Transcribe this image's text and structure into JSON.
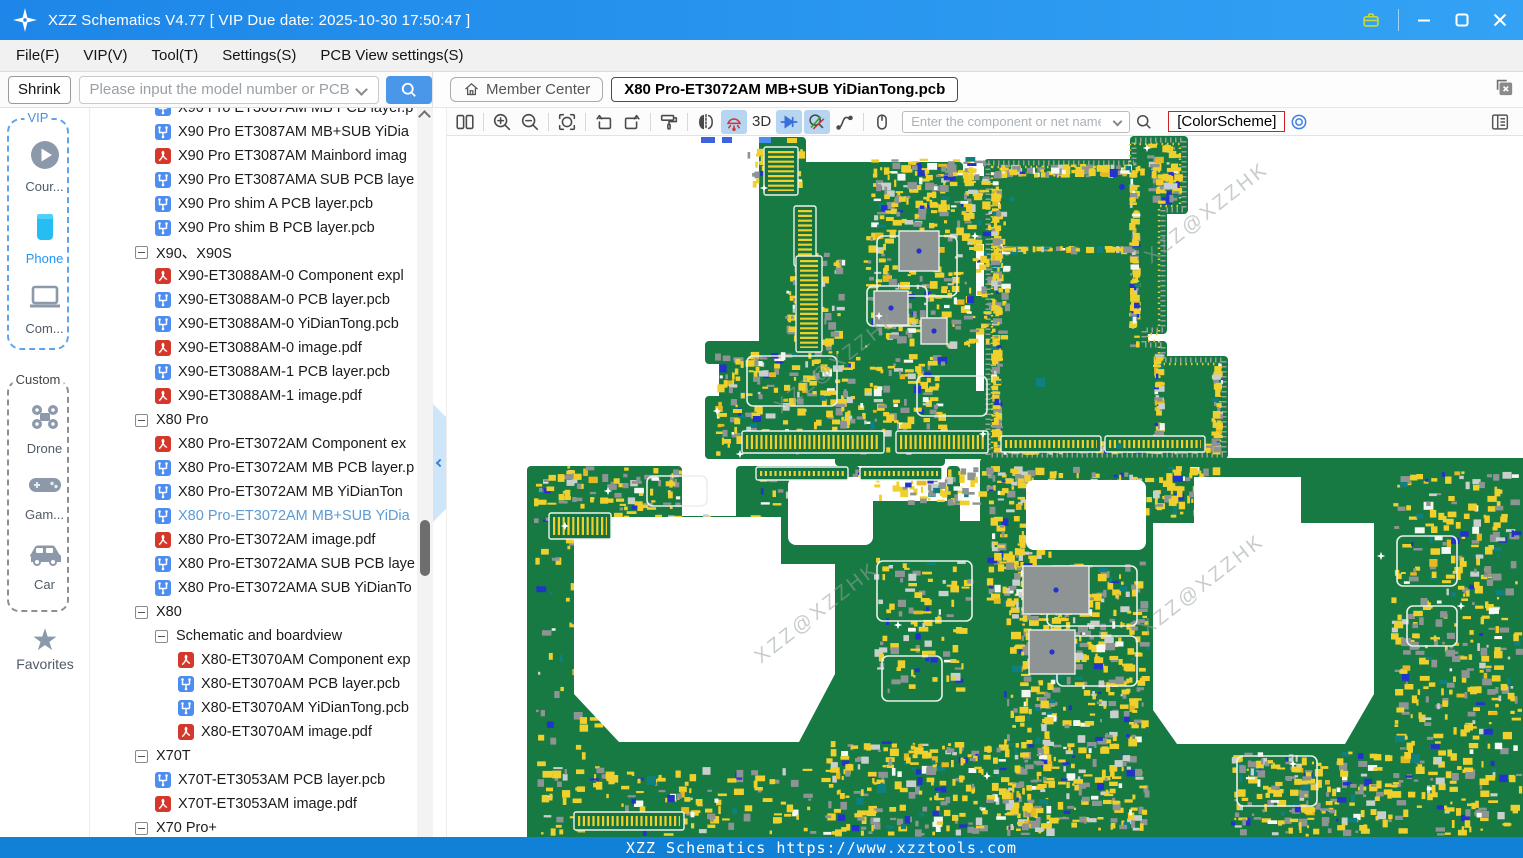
{
  "window": {
    "title": "XZZ Schematics V4.77 [ VIP Due date: 2025-10-30 17:50:47 ]",
    "controls": [
      "briefcase-icon",
      "minimize",
      "maximize",
      "close"
    ]
  },
  "menu": {
    "items": [
      "File(F)",
      "VIP(V)",
      "Tool(T)",
      "Settings(S)",
      "PCB View settings(S)"
    ]
  },
  "search_bar": {
    "shrink_label": "Shrink",
    "placeholder": "Please input the model number or PCB",
    "search_icon": "magnifier-icon"
  },
  "tab_bar": {
    "member_center_label": "Member Center",
    "member_center_icon": "home-icon",
    "active_tab": "X80 Pro-ET3072AM MB+SUB YiDianTong.pcb",
    "close_tabs_icon": "close-all-tabs-icon"
  },
  "pcb_toolbar": {
    "icons": [
      {
        "name": "split-view"
      },
      {
        "name": "|"
      },
      {
        "name": "zoom-in"
      },
      {
        "name": "zoom-out"
      },
      {
        "name": "|"
      },
      {
        "name": "rotate"
      },
      {
        "name": "|"
      },
      {
        "name": "rotate-left"
      },
      {
        "name": "rotate-right"
      },
      {
        "name": "|"
      },
      {
        "name": "paint-roller"
      },
      {
        "name": "|"
      },
      {
        "name": "mirror"
      },
      {
        "name": "lamp",
        "selected": true
      },
      {
        "name": "3d-label",
        "text": "3D"
      },
      {
        "name": "diode",
        "selected": true
      },
      {
        "name": "probe",
        "selected": true
      },
      {
        "name": "curve"
      },
      {
        "name": "|"
      },
      {
        "name": "mouse"
      }
    ],
    "net_input_placeholder": "Enter the component or net name",
    "colorscheme_label": "[ColorScheme]",
    "target_icon": "target-icon",
    "panel_icon": "panel-list-icon"
  },
  "sidebar": {
    "vip_label": "VIP",
    "custom_label": "Custom",
    "favorites_label": "Favorites",
    "items": [
      {
        "id": "course",
        "label": "Cour...",
        "icon": "play-circle-icon",
        "group": "vip",
        "active": false
      },
      {
        "id": "phone",
        "label": "Phone",
        "icon": "phone-icon",
        "group": "vip",
        "active": true
      },
      {
        "id": "computer",
        "label": "Com...",
        "icon": "laptop-icon",
        "group": "vip",
        "active": false
      },
      {
        "id": "drone",
        "label": "Drone",
        "icon": "drone-icon",
        "group": "custom",
        "active": false
      },
      {
        "id": "game",
        "label": "Gam...",
        "icon": "gamepad-icon",
        "group": "custom",
        "active": false
      },
      {
        "id": "car",
        "label": "Car",
        "icon": "car-icon",
        "group": "custom",
        "active": false
      }
    ]
  },
  "tree": {
    "items": [
      {
        "type": "pcb",
        "depth": 2,
        "label": "X90 Pro ET3087AM MB PCB layer.p"
      },
      {
        "type": "pcb",
        "depth": 2,
        "label": "X90 Pro ET3087AM MB+SUB YiDia"
      },
      {
        "type": "pdf",
        "depth": 2,
        "label": "X90 Pro ET3087AM Mainbord imag"
      },
      {
        "type": "pcb",
        "depth": 2,
        "label": "X90 Pro ET3087AMA SUB PCB laye"
      },
      {
        "type": "pcb",
        "depth": 2,
        "label": "X90 Pro shim A PCB layer.pcb"
      },
      {
        "type": "pcb",
        "depth": 2,
        "label": "X90 Pro shim B PCB layer.pcb"
      },
      {
        "type": "group",
        "depth": 1,
        "label": "X90、X90S"
      },
      {
        "type": "pdf",
        "depth": 2,
        "label": "X90-ET3088AM-0 Component expl"
      },
      {
        "type": "pcb",
        "depth": 2,
        "label": "X90-ET3088AM-0 PCB layer.pcb"
      },
      {
        "type": "pcb",
        "depth": 2,
        "label": "X90-ET3088AM-0 YiDianTong.pcb"
      },
      {
        "type": "pdf",
        "depth": 2,
        "label": "X90-ET3088AM-0 image.pdf"
      },
      {
        "type": "pcb",
        "depth": 2,
        "label": "X90-ET3088AM-1 PCB layer.pcb"
      },
      {
        "type": "pdf",
        "depth": 2,
        "label": "X90-ET3088AM-1 image.pdf"
      },
      {
        "type": "group",
        "depth": 1,
        "label": "X80 Pro"
      },
      {
        "type": "pdf",
        "depth": 2,
        "label": "X80 Pro-ET3072AM Component ex"
      },
      {
        "type": "pcb",
        "depth": 2,
        "label": "X80 Pro-ET3072AM MB PCB layer.p"
      },
      {
        "type": "pcb",
        "depth": 2,
        "label": "X80 Pro-ET3072AM MB YiDianTon"
      },
      {
        "type": "pcb",
        "depth": 2,
        "label": "X80 Pro-ET3072AM MB+SUB YiDia",
        "selected": true
      },
      {
        "type": "pdf",
        "depth": 2,
        "label": "X80 Pro-ET3072AM image.pdf"
      },
      {
        "type": "pcb",
        "depth": 2,
        "label": "X80 Pro-ET3072AMA SUB PCB laye"
      },
      {
        "type": "pcb",
        "depth": 2,
        "label": "X80 Pro-ET3072AMA SUB YiDianTo"
      },
      {
        "type": "group",
        "depth": 1,
        "label": "X80"
      },
      {
        "type": "group",
        "depth": 2,
        "label": "Schematic and boardview"
      },
      {
        "type": "pdf",
        "depth": 3,
        "label": "X80-ET3070AM Component exp"
      },
      {
        "type": "pcb",
        "depth": 3,
        "label": "X80-ET3070AM PCB layer.pcb"
      },
      {
        "type": "pcb",
        "depth": 3,
        "label": "X80-ET3070AM YiDianTong.pcb"
      },
      {
        "type": "pdf",
        "depth": 3,
        "label": "X80-ET3070AM image.pdf"
      },
      {
        "type": "group",
        "depth": 1,
        "label": "X70T"
      },
      {
        "type": "pcb",
        "depth": 2,
        "label": "X70T-ET3053AM PCB layer.pcb"
      },
      {
        "type": "pdf",
        "depth": 2,
        "label": "X70T-ET3053AM image.pdf"
      },
      {
        "type": "group",
        "depth": 1,
        "label": "X70 Pro+"
      }
    ]
  },
  "canvas": {
    "watermark": "XZZ@XZZHK"
  },
  "footer": {
    "text": "XZZ Schematics https://www.xzztools.com"
  },
  "colors": {
    "titlebar_blue": "#1d86e8",
    "footer_blue": "#1181d8",
    "board_green": "#177a43",
    "component_yellow": "#f0d02c",
    "component_gray": "#8e9494",
    "selected_tool_bg": "#b5d5f2",
    "colorscheme_border_red": "#cc2222",
    "selected_tree_text": "#5b9bd5"
  }
}
